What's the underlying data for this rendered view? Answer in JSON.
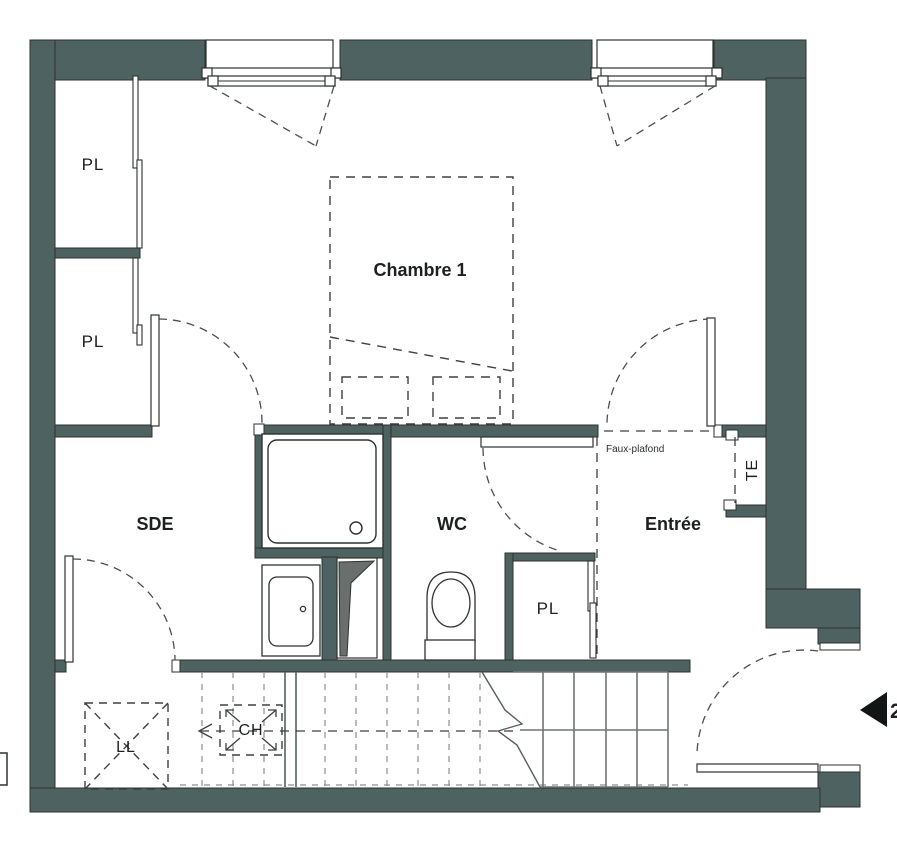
{
  "plan": {
    "type": "apartment floor plan",
    "wall_color": "#4e6361",
    "background_color": "#ffffff"
  },
  "rooms": {
    "chambre1": {
      "label": "Chambre 1"
    },
    "sde": {
      "label": "SDE"
    },
    "wc": {
      "label": "WC"
    },
    "entree": {
      "label": "Entrée"
    }
  },
  "closets": {
    "pl_top": {
      "label": "PL"
    },
    "pl_middle": {
      "label": "PL"
    },
    "pl_entree": {
      "label": "PL"
    }
  },
  "equipment": {
    "ll": {
      "label": "LL"
    },
    "ch": {
      "label": "CH"
    },
    "te": {
      "label": "TE"
    }
  },
  "annotations": {
    "faux_plafond": "Faux-plafond",
    "level_arrow_label": "2"
  }
}
